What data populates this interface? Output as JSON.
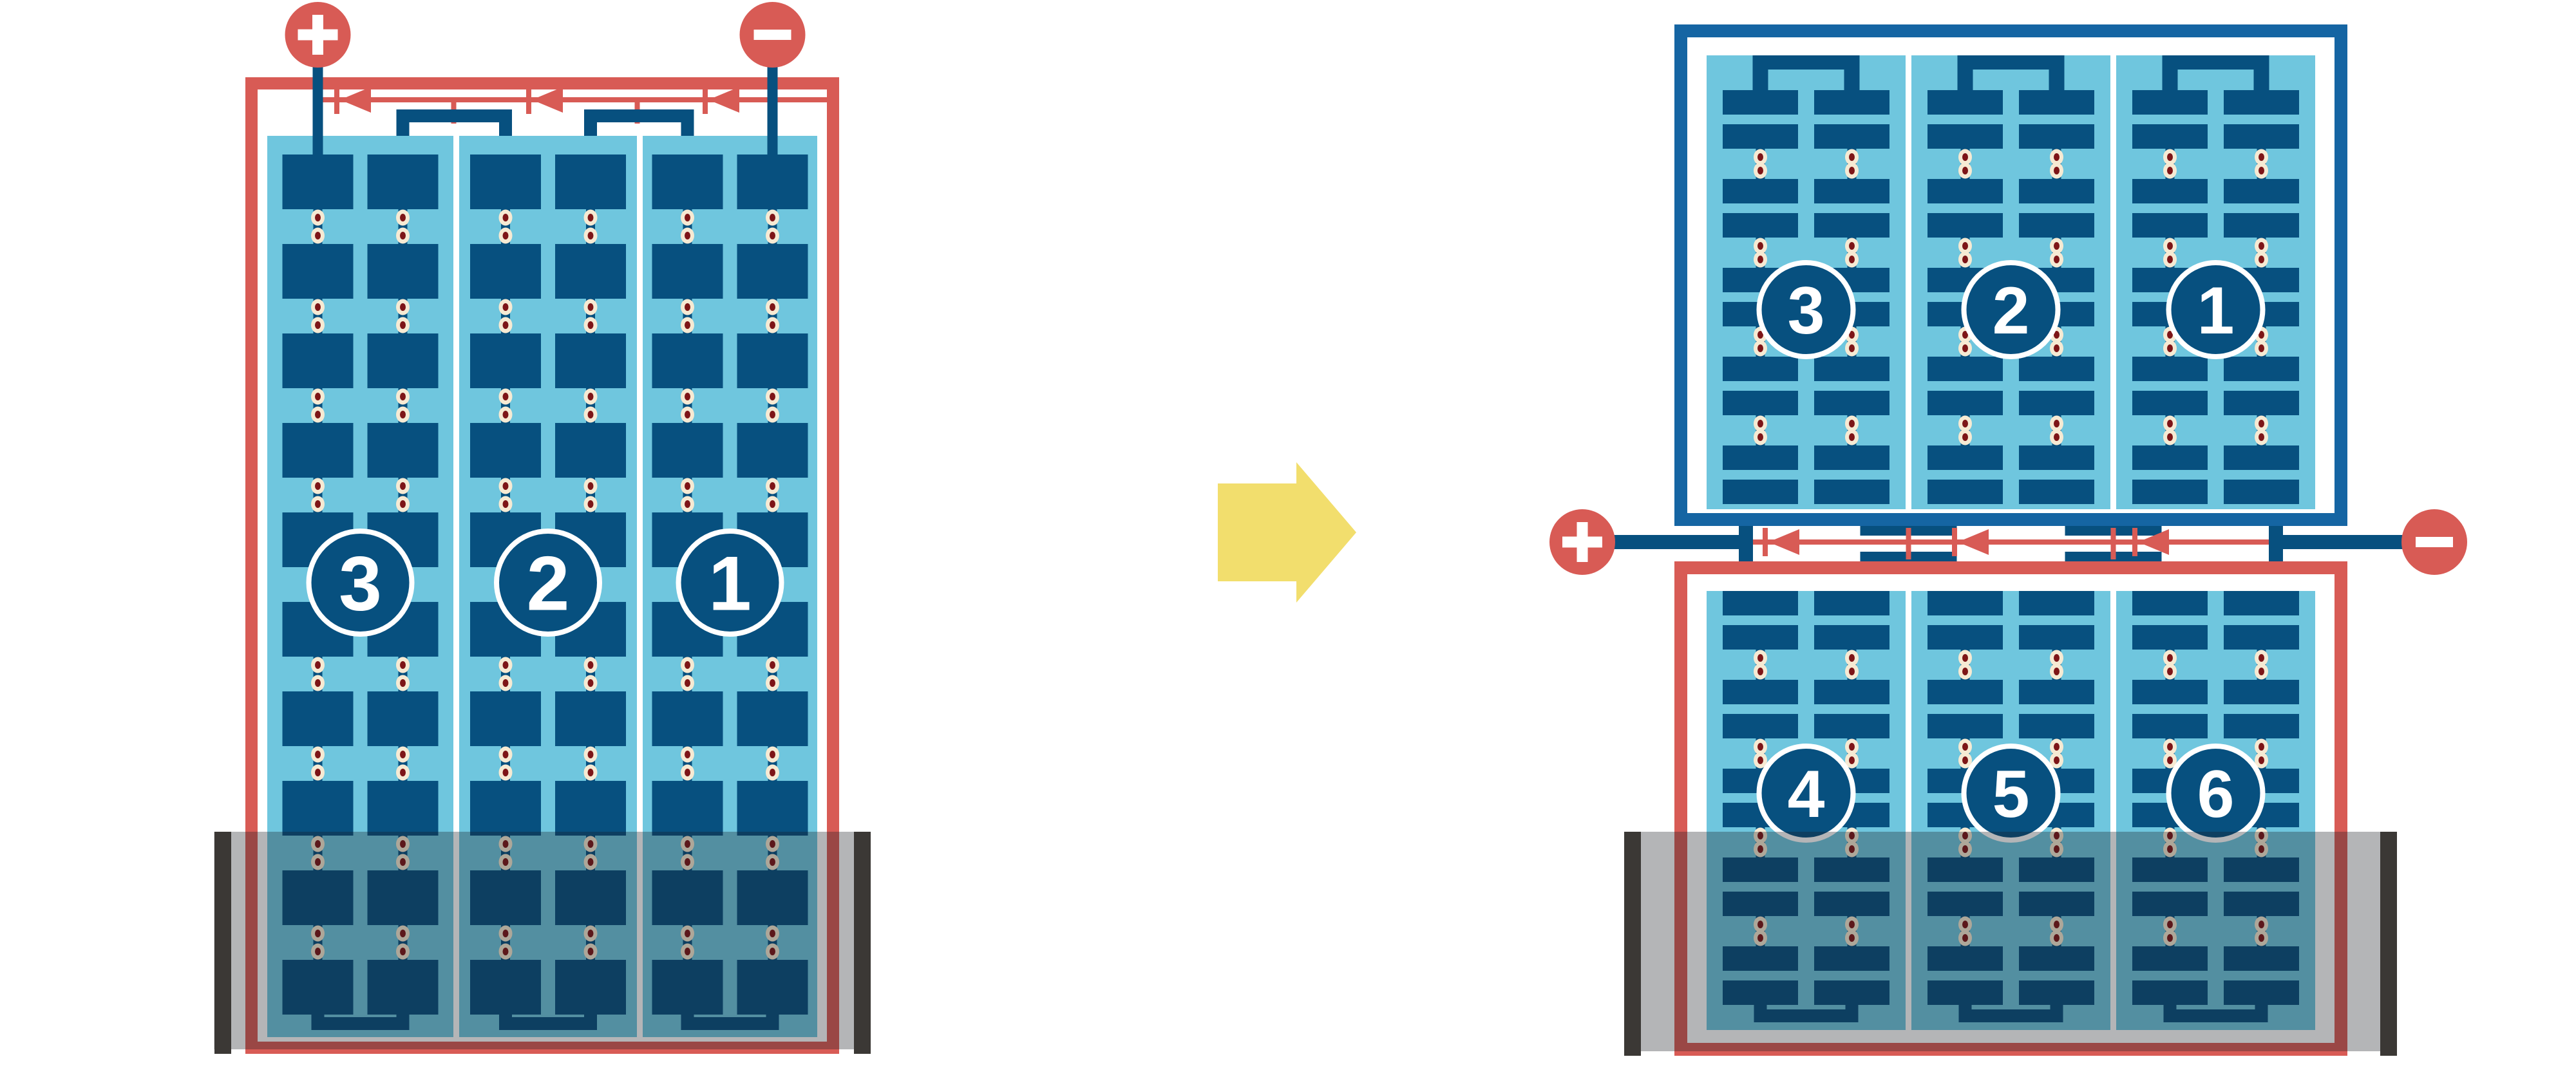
{
  "colors": {
    "wire_red": "#D85B55",
    "cell_navy": "#07507F",
    "frame_blue": "#1565A3",
    "panel_light_blue": "#6FC6DE",
    "solder_cream": "#F6EAD3",
    "solder_core_red": "#7D1517",
    "arrow_yellow": "#F2DE6D",
    "shadow_fill": "#1A1E24",
    "shadow_opacity": 0.33,
    "shade_bar_gray": "#3B3835",
    "glyph_white": "#FFFFFF"
  },
  "left_module": {
    "terminal_labels": {
      "positive": "+",
      "negative": "−"
    },
    "string_labels": [
      "3",
      "2",
      "1"
    ],
    "strings": 3,
    "rows_per_string": 10,
    "columns_per_string": 2,
    "bypass_diodes": 3,
    "shaded_bottom": true
  },
  "right_module": {
    "terminal_labels": {
      "positive": "+",
      "negative": "−"
    },
    "top_string_labels": [
      "3",
      "2",
      "1"
    ],
    "bottom_string_labels": [
      "4",
      "5",
      "6"
    ],
    "strings_per_half": 3,
    "row_pairs_per_half": 5,
    "columns_per_string": 2,
    "bypass_diodes": 3,
    "shaded_bottom": true
  },
  "arrow": {
    "direction": "right"
  }
}
